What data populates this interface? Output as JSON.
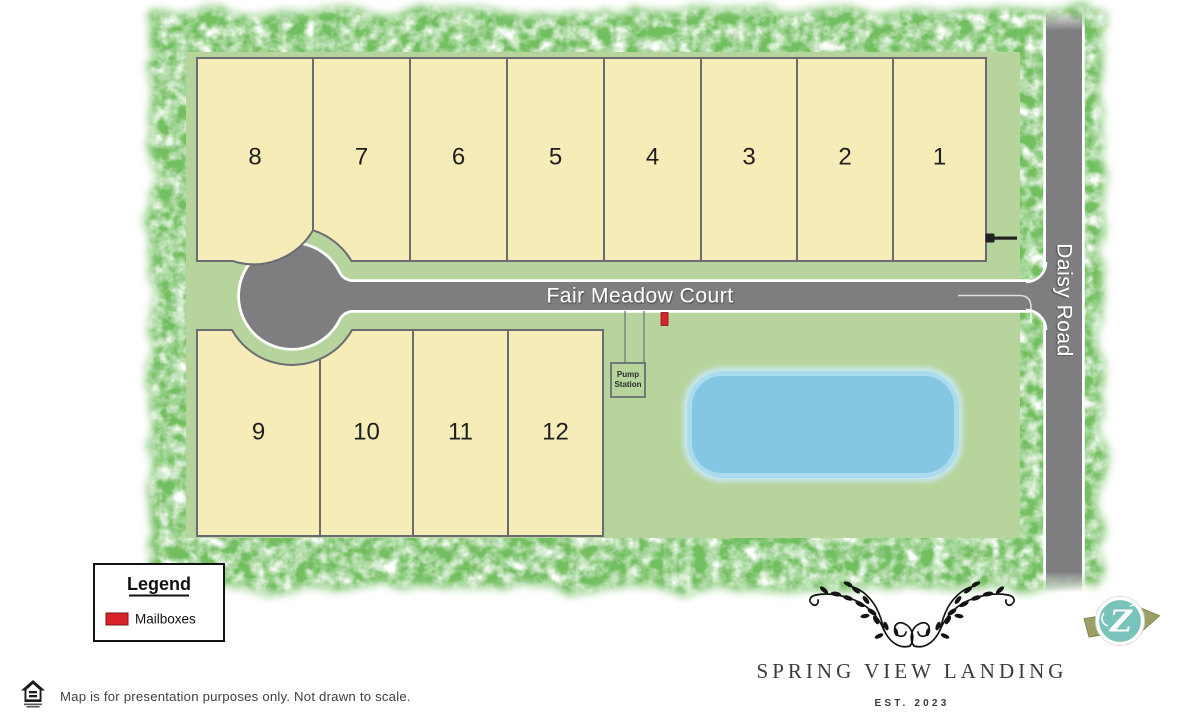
{
  "map": {
    "road_horizontal": "Fair Meadow Court",
    "road_vertical": "Daisy Road",
    "lots_top": [
      "8",
      "7",
      "6",
      "5",
      "4",
      "3",
      "2",
      "1"
    ],
    "lots_bottom": [
      "9",
      "10",
      "11",
      "12"
    ],
    "pump_station": {
      "line1": "Pump",
      "line2": "Station"
    }
  },
  "legend": {
    "title": "Legend",
    "items": [
      {
        "label": "Mailboxes",
        "color": "#d8232a"
      }
    ]
  },
  "footer": {
    "disclaimer": "Map is for presentation purposes only. Not drawn to scale."
  },
  "branding": {
    "name": "SPRING VIEW LANDING",
    "established": "EST. 2023",
    "builder_initial": "Z"
  },
  "colors": {
    "lot_fill": "#f5ecb8",
    "lot_border": "#6b6b74",
    "site_green": "#b7d49c",
    "border_green": "#72bf60",
    "road_gray": "#7e7e80",
    "pond_blue": "#85c6e2",
    "mailbox_red": "#d8232a",
    "logo_teal": "#7ac3bb",
    "logo_olive": "#9e9e67"
  }
}
